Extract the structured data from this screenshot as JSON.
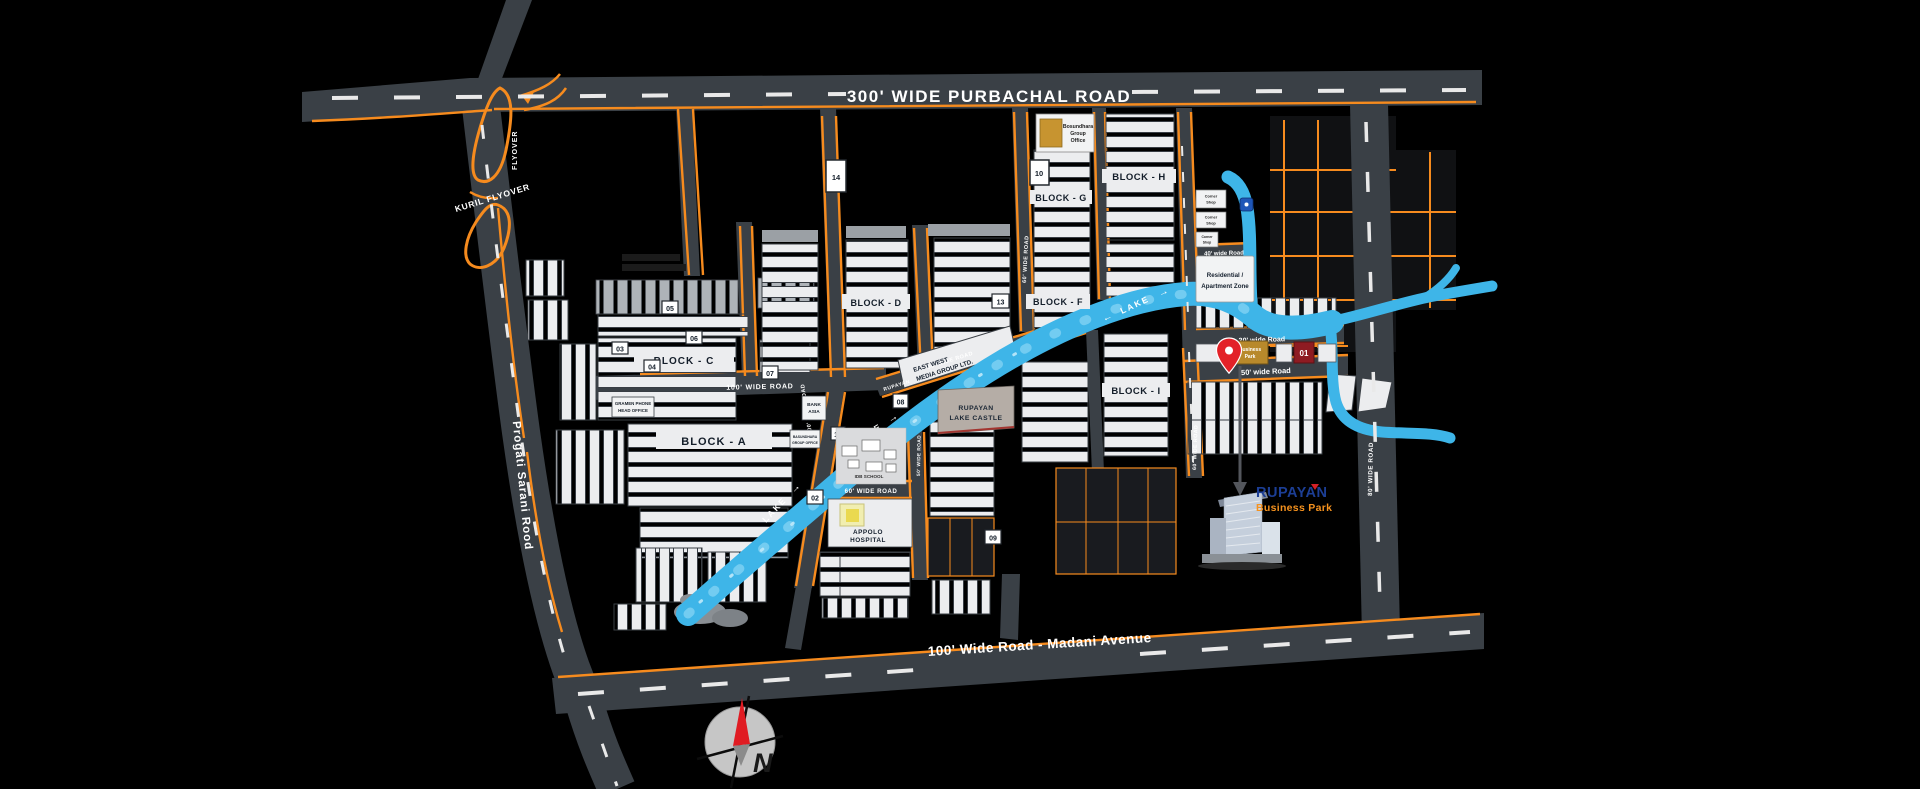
{
  "colors": {
    "road": "#3A4046",
    "accent_orange": "#F68B1E",
    "lake_blue": "#3EB5E8",
    "parcel": "#ECEDEF",
    "gold": "#B8892B",
    "maroon": "#8E1B22",
    "pin_red": "#E32228",
    "logo_blue": "#1C3E95",
    "logo_orange": "#F6921E"
  },
  "roads": {
    "purbachal": "300' WIDE PURBACHAL ROAD",
    "madani": "100' Wide Road - Madani Avenue",
    "progati": "Progati  Sarani Rood",
    "kuril": "KURIL FLYOVER",
    "flyover": "FLYOVER",
    "w100h": "100' WIDE ROAD",
    "w100v": "100' WIDE ROAD",
    "w60v": "60' WIDE ROAD",
    "w60v2": "60' WIDE ROAD",
    "w60h": "60' WIDE ROAD",
    "w60diag": "60' WIDE ROAD",
    "w50v": "50' WIDE ROAD",
    "w80v": "80' WIDE ROAD",
    "w30": "30' wide Road",
    "w50": "50' wide Road",
    "w40": "40' wide Road",
    "rupayan_st": "RUPAYAN"
  },
  "blocks": {
    "a": "BLOCK - A",
    "c": "BLOCK - C",
    "d": "BLOCK - D",
    "f": "BLOCK - F",
    "g": "BLOCK - G",
    "h": "BLOCK - H",
    "i": "BLOCK - I"
  },
  "plots": {
    "p01": "01",
    "p02": "02",
    "p03": "03",
    "p04": "04",
    "p05": "05",
    "p06": "06",
    "p07": "07",
    "p08": "08",
    "p09": "09",
    "p10": "10",
    "p11": "11",
    "p12": "12",
    "p13": "13",
    "p14": "14"
  },
  "places": {
    "bosundhara_l1": "Bosundhara",
    "bosundhara_l2": "Group",
    "bosundhara_l3": "Office",
    "gramen_l1": "GRAMEN PHONE",
    "gramen_l2": "HEAD OFFICE",
    "bank_l1": "BANK",
    "bank_l2": "ASIA",
    "bgo_l1": "BASUNDHARA",
    "bgo_l2": "GROUP OFFICE",
    "eastwest_l1": "EAST WEST",
    "eastwest_l2": "MEDIA GROUP LTD.",
    "lakecastle_l1": "RUPAYAN",
    "lakecastle_l2": "LAKE CASTLE",
    "school": "IDB SCHOOL",
    "hospital_l1": "APPOLO",
    "hospital_l2": "HOSPITAL",
    "corner_l1": "Corner",
    "corner_l2": "Shop",
    "residential_l1": "Residential /",
    "residential_l2": "Apartment Zone",
    "bpark_l1": "Business",
    "bpark_l2": "Park"
  },
  "lake": {
    "label": "LAKE",
    "arrow_left": "←",
    "arrow_right": "→"
  },
  "logo": {
    "name": "RUPAYAN",
    "tagline": "Business Park"
  },
  "compass": {
    "north": "N"
  }
}
